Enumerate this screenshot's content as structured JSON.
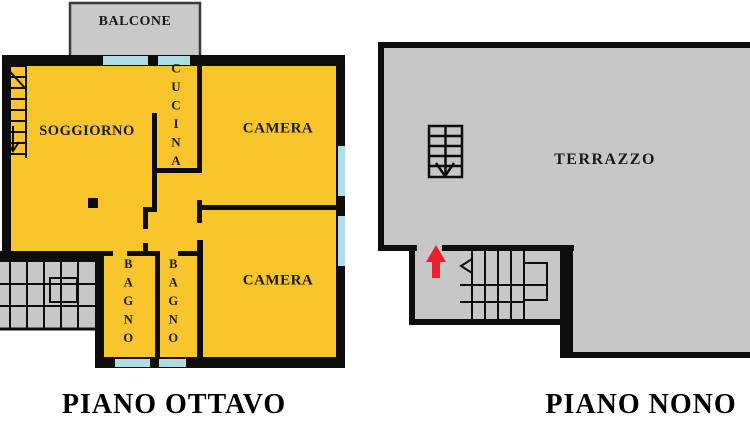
{
  "colors": {
    "background": "#ffffff",
    "apartment-fill": "#F9C52D",
    "terrace-fill": "#C7C7C7",
    "balcony-fill": "#C9C9C9",
    "wall": "#0d0d0d",
    "window": "#AFDDE5",
    "stairs-arrow-red": "#E8212B",
    "label-text": "#1a1a1a"
  },
  "plans": [
    {
      "title": "PIANO OTTAVO",
      "rooms": {
        "balcone": "BALCONE",
        "soggiorno": "SOGGIORNO",
        "cucina": "CUCINA",
        "camera_nord": "CAMERA",
        "camera_sud": "CAMERA",
        "bagno_1": "BAGNO",
        "bagno_2": "BAGNO"
      }
    },
    {
      "title": "PIANO NONO",
      "rooms": {
        "terrazzo": "TERRAZZO"
      }
    }
  ]
}
